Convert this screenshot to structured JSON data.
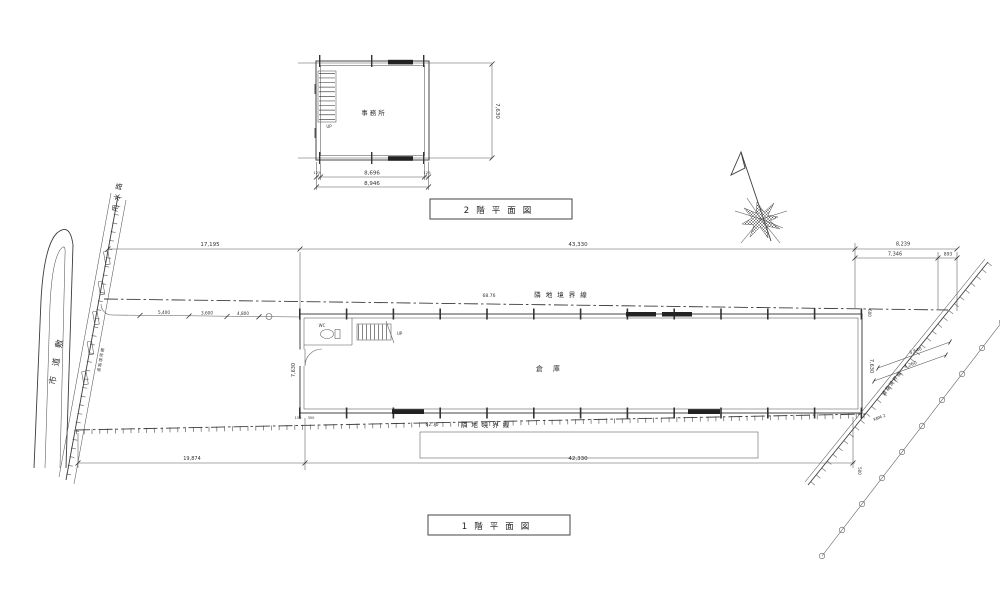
{
  "colors": {
    "ink": "#3c3c3c",
    "paper": "#ffffff"
  },
  "plan2f": {
    "title": "2階平面図",
    "room": "事務所",
    "stair": "UP",
    "dim_side": "7,630",
    "dim_end1": "125",
    "dim_mid": "8,696",
    "dim_end2": "125",
    "dim_total": "8,946"
  },
  "plan1f": {
    "title": "1階平面図",
    "room": "倉庫",
    "wc": "WC",
    "stair": "UP",
    "dim_left": "7,630",
    "dim_right": "7,630",
    "dim_600": "600",
    "dim_500": "500",
    "dim_150": "150",
    "dim_350": "350",
    "note": "KBM 2"
  },
  "site": {
    "dim_top_left": "17,195",
    "dim_top_mid": "43,330",
    "dim_top_right_total": "8,239",
    "dim_top_right_a": "7,346",
    "dim_top_right_b": "893",
    "dim_bottom_left": "19,874",
    "dim_bottom_mid": "42,330",
    "fence_a": "5,400",
    "fence_b": "3,600",
    "fence_c": "4,800",
    "diag_a": "3,640",
    "diag_b": "4,260",
    "boundary_top_length": "68.76",
    "boundary_top_label": "隣地境界線",
    "boundary_bottom_length": "62.70",
    "boundary_bottom_label": "隣地境界線",
    "road_right_label": "道路境界線",
    "road_left_label": "道路境界線",
    "waterway_label": "用水路",
    "road_label": "市道敷"
  }
}
